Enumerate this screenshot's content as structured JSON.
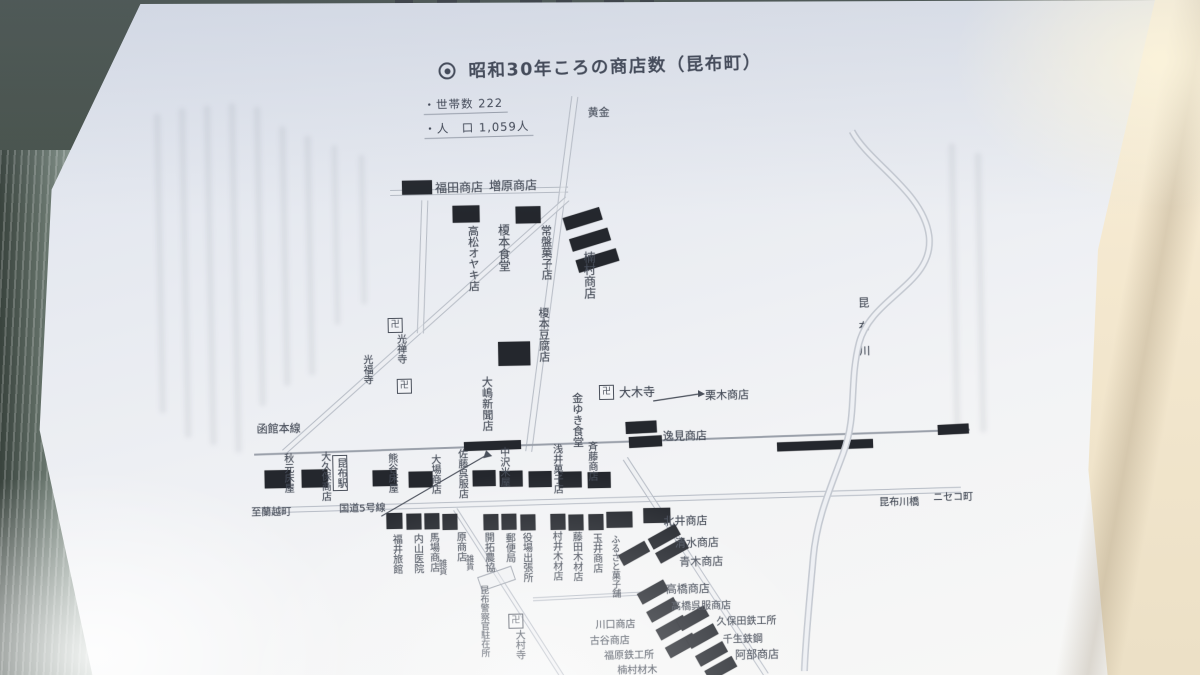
{
  "page": {
    "header_fragments": [
      "野",
      "遊"
    ],
    "margin_text": {
      "col_right": "た、玉井商店は、二八年の改築を機に、品物を運んできて買えるように工夫していたし、高橋商店は、",
      "col_left": "まで合わせてやってきた製材工場を止めての経営であった。"
    }
  },
  "map": {
    "title": "昭和30年ころの商店数（昆布町）",
    "stats": {
      "households_label": "・世帯数",
      "households_value": "222",
      "population_label": "・人　口",
      "population_value": "1,059人"
    },
    "routes": {
      "railway": "函館本線",
      "national_route": "国道5号線",
      "river": "昆布川",
      "bridge": "昆布川橋",
      "dest_top": "黄金",
      "dest_left": "至蘭越町",
      "dest_right": "ニセコ町"
    },
    "station": "昆布駅",
    "temple_mark": "卍",
    "labels": {
      "fukuda": "福田商店",
      "masuhara": "増原商店",
      "takamatsu": "高松オヤキ店",
      "enomoto_shokudo": "榎本食堂",
      "tokiwa_kashi": "常盤菓子店",
      "kusumura": "楠村商店",
      "enomoto_tofu": "榎本豆腐店",
      "kozenji": "光禅寺",
      "kofukuji": "光福寺",
      "oshima_shimbun": "大嶋新聞店",
      "omokiji": "大木寺",
      "kuriki": "栗木商店",
      "kaneyuki_shokudo": "金ゆき食堂",
      "itsumi": "逸見商店",
      "akimoto": "秋元床屋",
      "okubo": "大久保商店",
      "kumagai": "熊谷床屋",
      "oba": "大場商店",
      "sato": "佐藤呉服店",
      "nakazawa": "中沢米屋",
      "asai": "浅井菓子店",
      "saito": "斉藤商店",
      "fukui_ryokan": "福井旅館",
      "uchiyama_clinic": "内山医院",
      "baba": "馬場商店",
      "baba_note": "雑貨",
      "hara": "原商店",
      "hara_note": "雑貨",
      "kaitaku_nokyo": "開拓農協",
      "yubinkyoku": "郵便局",
      "yakuba": "役場出張所",
      "murai_mokuzai": "村井木材店",
      "fujita_mokuzai": "藤田木材店",
      "tamai": "玉井商店",
      "furusato_kashiho": "ふるさと菓子舗",
      "police": "昆布警察官駐在所",
      "omuraji": "大村寺",
      "kitai": "北井商店",
      "shimizu": "清水商店",
      "aoki": "青木商店",
      "takahashi": "高橋商店",
      "takahashi_gofuku": "高橋呉服商店",
      "kubota": "久保田鉄工所",
      "sennama": "千生鉄鋼",
      "abe": "阿部商店",
      "kawaguchi": "川口商店",
      "furuya": "古谷商店",
      "fukuhara": "福原鉄工所",
      "kusumura_zaimoku": "楠村材木"
    }
  }
}
